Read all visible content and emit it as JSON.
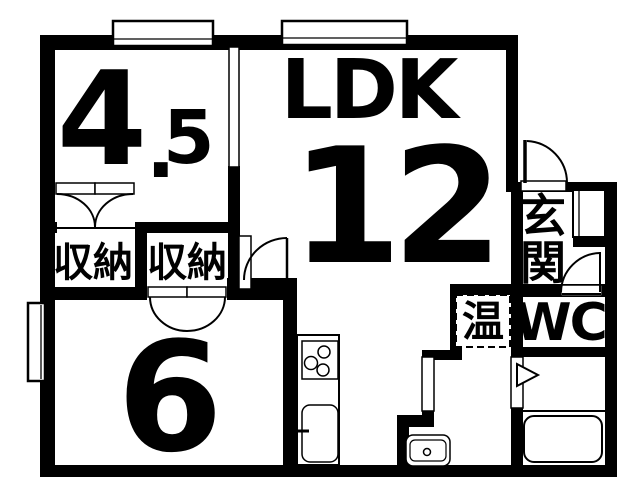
{
  "document": {
    "type": "floor-plan"
  },
  "colors": {
    "line": "#000000",
    "background": "#ffffff"
  },
  "labels": {
    "western_room": {
      "size_main": "4",
      "size_point": ".",
      "size_frac": "5"
    },
    "ldk": {
      "name": "LDK",
      "size": "12"
    },
    "tatami_room": {
      "size": "6"
    },
    "closet_left": "収納",
    "closet_right": "収納",
    "entrance": "玄関",
    "toilet": "WC",
    "water_heater": "温"
  }
}
